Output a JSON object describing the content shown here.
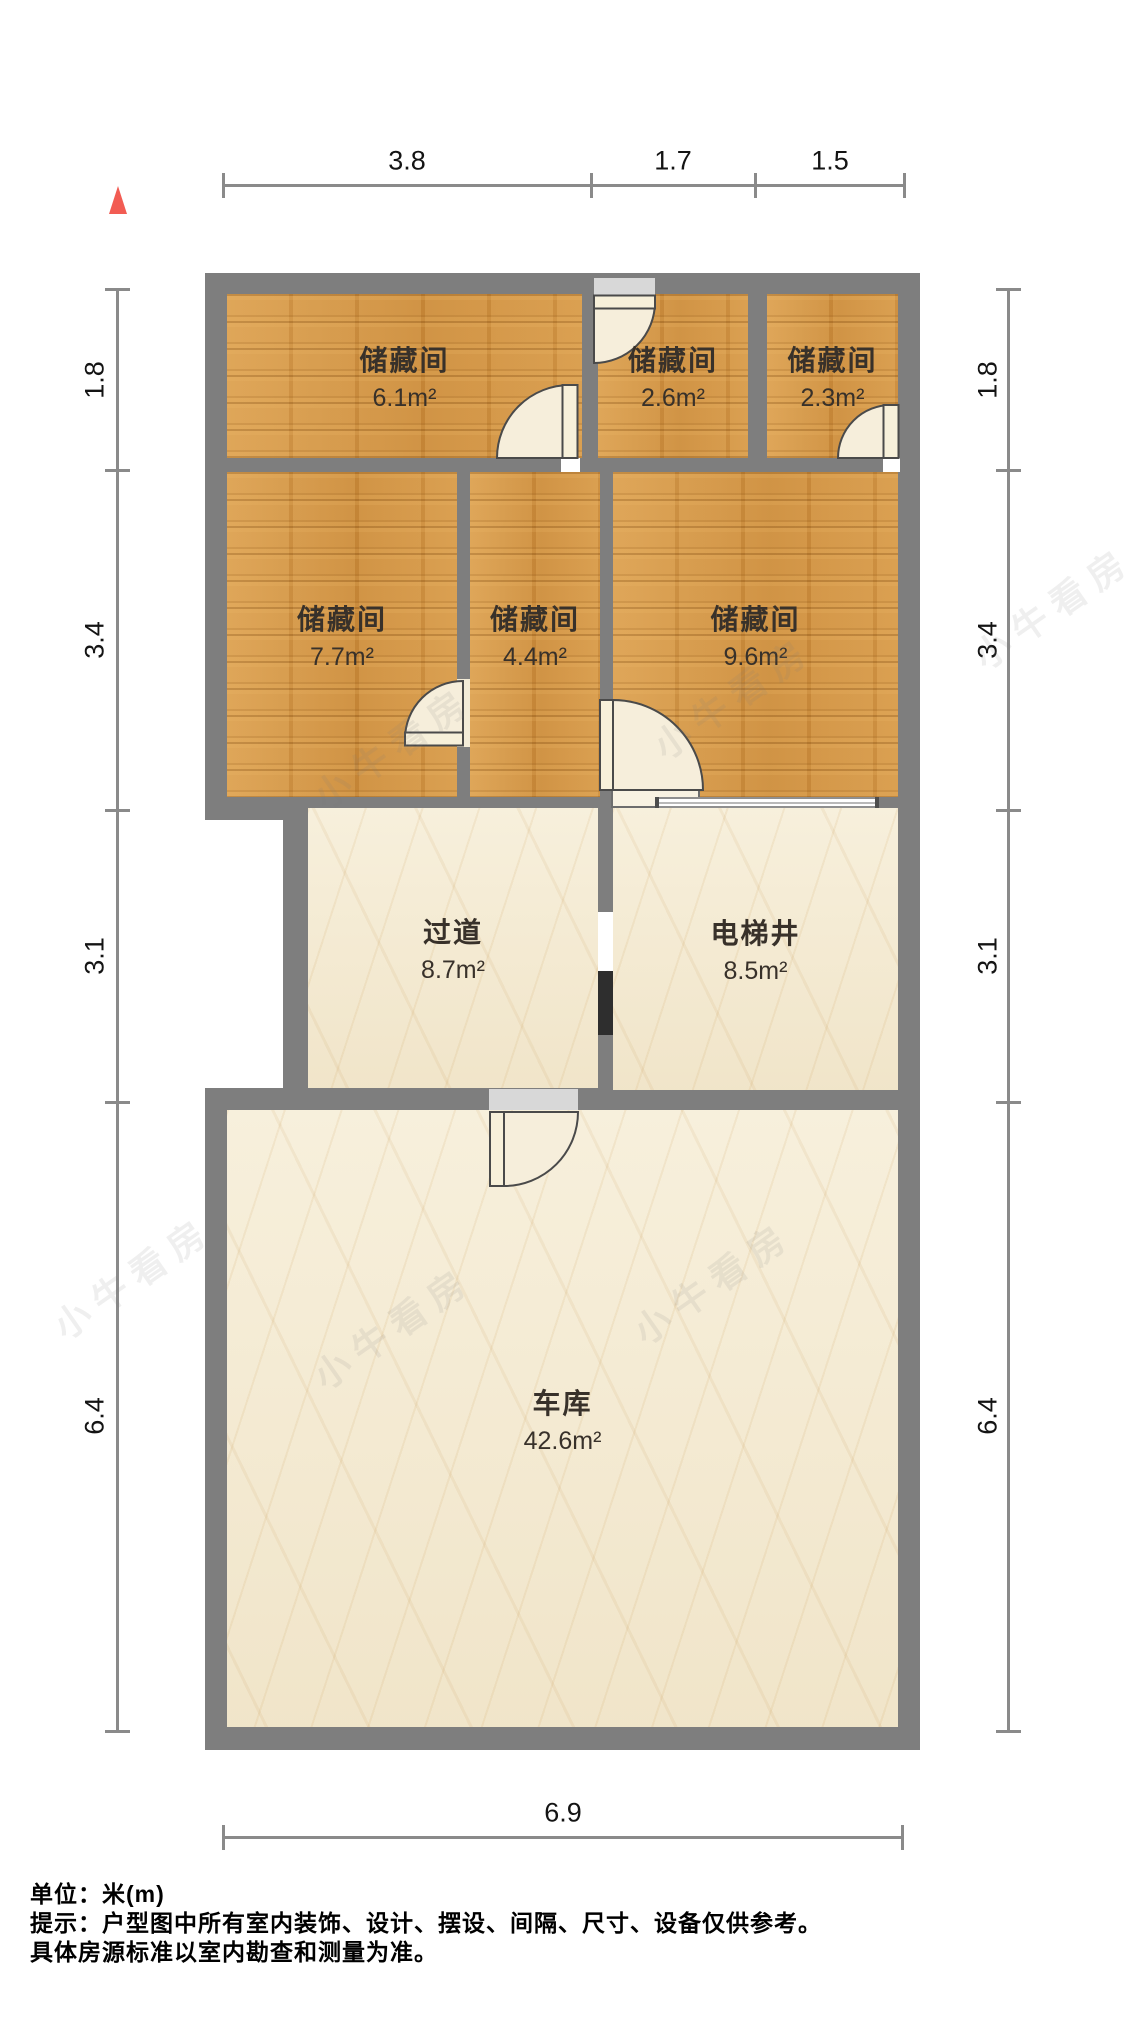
{
  "compass": {
    "icon": "north-arrow"
  },
  "dims": {
    "top": [
      "3.8",
      "1.7",
      "1.5"
    ],
    "left": [
      "1.8",
      "3.4",
      "3.1",
      "6.4"
    ],
    "right": [
      "1.8",
      "3.4",
      "3.1",
      "6.4"
    ],
    "bottom": [
      "6.9"
    ]
  },
  "rooms": [
    {
      "name": "储藏间",
      "area": "6.1m²"
    },
    {
      "name": "储藏间",
      "area": "2.6m²"
    },
    {
      "name": "储藏间",
      "area": "2.3m²"
    },
    {
      "name": "储藏间",
      "area": "7.7m²"
    },
    {
      "name": "储藏间",
      "area": "4.4m²"
    },
    {
      "name": "储藏间",
      "area": "9.6m²"
    },
    {
      "name": "过道",
      "area": "8.7m²"
    },
    {
      "name": "电梯井",
      "area": "8.5m²"
    },
    {
      "name": "车库",
      "area": "42.6m²"
    }
  ],
  "watermark": {
    "text": "小牛看房"
  },
  "footer": {
    "unit": "单位：米(m)",
    "tip1": "提示：户型图中所有室内装饰、设计、摆设、间隔、尺寸、设备仅供参考。",
    "tip2": "具体房源标准以室内勘查和测量为准。"
  },
  "colors": {
    "wall": "#7e7e7e",
    "wood_floor": "#d2913e",
    "marble_floor": "#f3e9d1",
    "compass_red": "#f25c53",
    "dim_line": "#8a8a8a"
  }
}
